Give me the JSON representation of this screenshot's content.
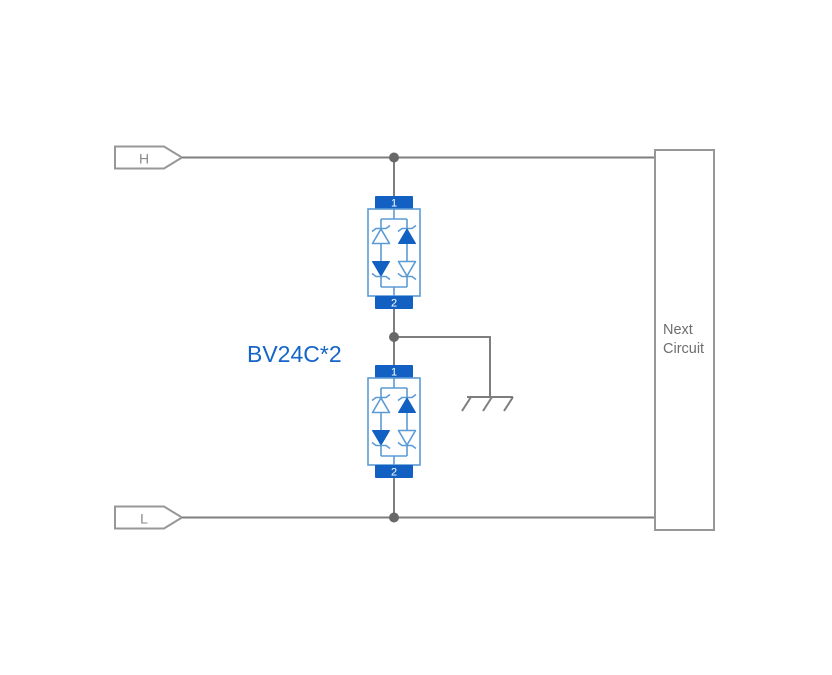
{
  "labels": {
    "h": "H",
    "l": "L",
    "component": "BV24C*2",
    "next_line1": "Next",
    "next_line2": "Circuit"
  },
  "tvs_top": {
    "pin1": "1",
    "pin2": "2"
  },
  "tvs_bottom": {
    "pin1": "1",
    "pin2": "2"
  },
  "colors": {
    "bg": "#ffffff",
    "wire": "#7e7e7e",
    "outline-gray": "#979797",
    "junction": "#686868",
    "blue-fill": "#1160c2",
    "blue-outline": "#5b9bd5",
    "blue-text": "#1565c8",
    "gray-text": "#8a8a8a",
    "gray-text2": "#6e6e6e"
  }
}
